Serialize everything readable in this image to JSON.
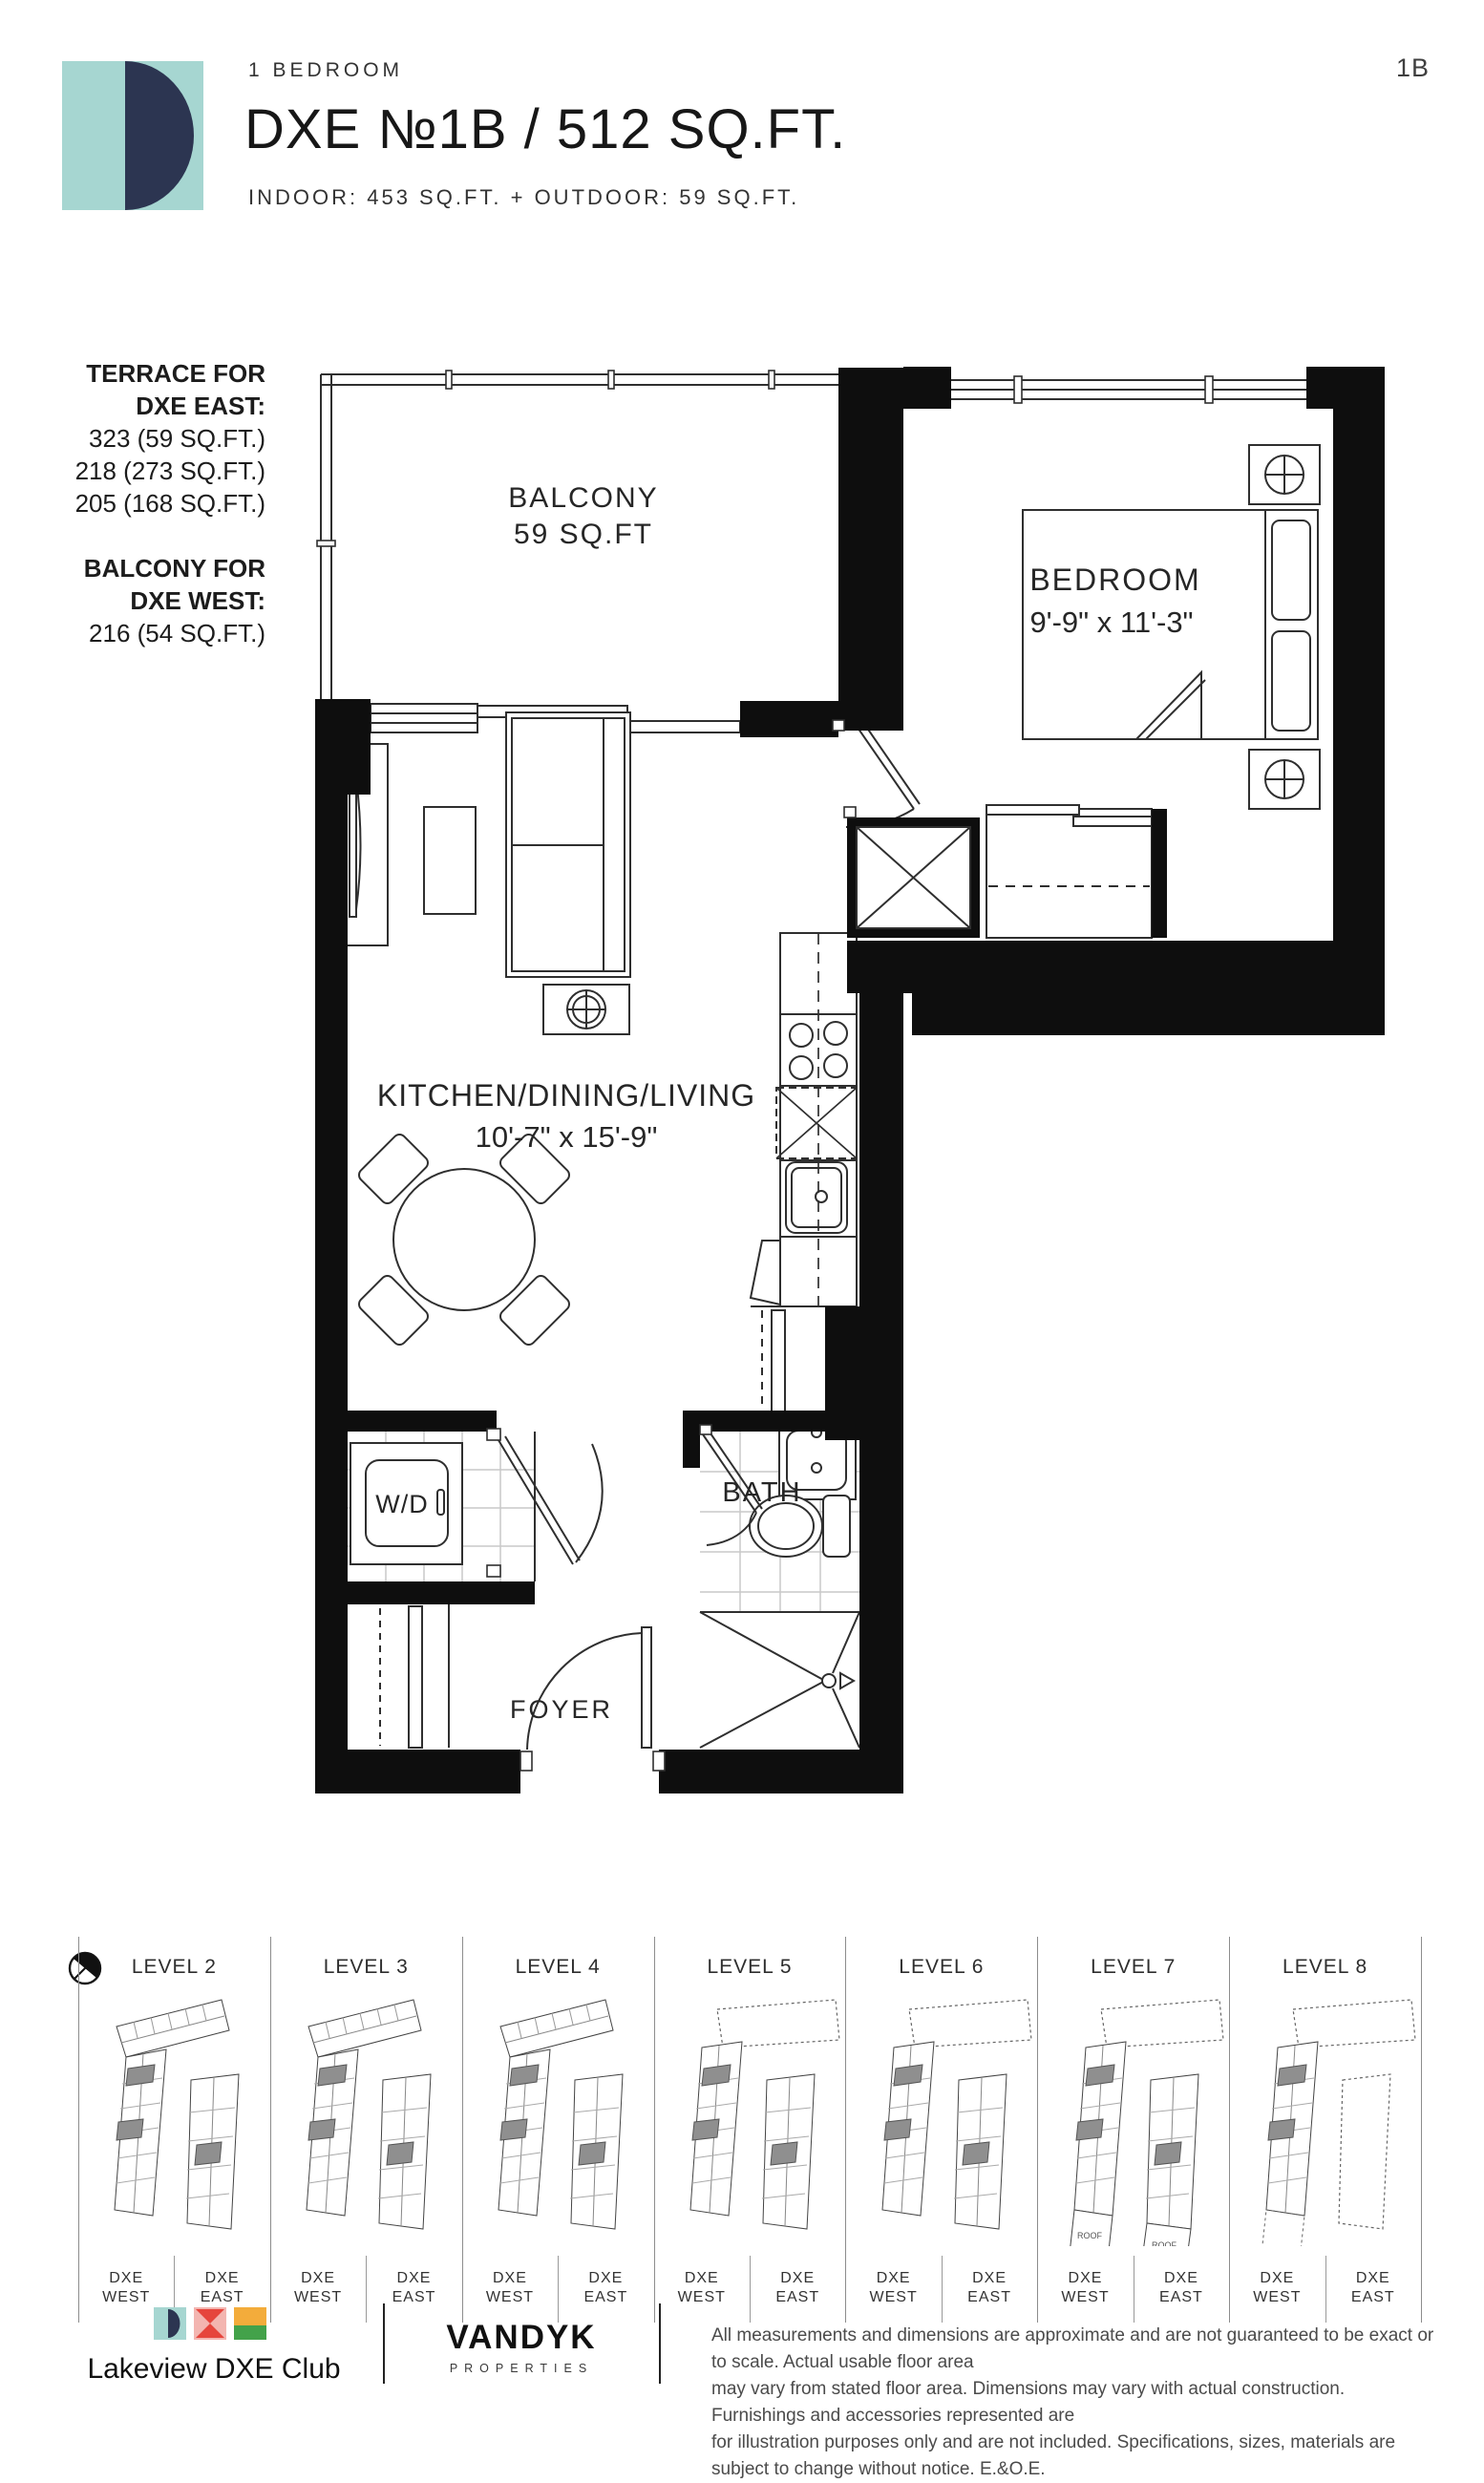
{
  "page": {
    "code": "1B"
  },
  "header": {
    "category": "1 BEDROOM",
    "title": "DXE №1B / 512 SQ.FT.",
    "subtitle": "INDOOR: 453 SQ.FT. + OUTDOOR: 59 SQ.FT."
  },
  "annotations": {
    "terrace_heading_line1": "TERRACE FOR",
    "terrace_heading_line2": "DXE EAST:",
    "terrace_items": [
      "323 (59 SQ.FT.)",
      "218 (273 SQ.FT.)",
      "205 (168 SQ.FT.)"
    ],
    "balcony_heading_line1": "BALCONY FOR",
    "balcony_heading_line2": "DXE WEST:",
    "balcony_items": [
      "216 (54 SQ.FT.)"
    ]
  },
  "plan": {
    "balcony_label": "BALCONY",
    "balcony_area": "59 SQ.FT",
    "bedroom_label": "BEDROOM",
    "bedroom_dims": "9'-9\" x 11'-3\"",
    "living_label": "KITCHEN/DINING/LIVING",
    "living_dims": "10'-7\" x 15'-9\"",
    "wd_label": "W/D",
    "bath_label": "BATH",
    "foyer_label": "FOYER"
  },
  "levels": {
    "west_label_line1": "DXE",
    "west_label_line2": "WEST",
    "east_label_line1": "DXE",
    "east_label_line2": "EAST",
    "roof_label": "ROOF",
    "items": [
      {
        "label": "LEVEL 2",
        "dotted_top": false,
        "east_gray": true,
        "east_dashed": false,
        "roof_west": false,
        "roof_east": false,
        "west_ext_dashed": false
      },
      {
        "label": "LEVEL 3",
        "dotted_top": false,
        "east_gray": true,
        "east_dashed": false,
        "roof_west": false,
        "roof_east": false,
        "west_ext_dashed": false
      },
      {
        "label": "LEVEL 4",
        "dotted_top": false,
        "east_gray": true,
        "east_dashed": false,
        "roof_west": false,
        "roof_east": false,
        "west_ext_dashed": false
      },
      {
        "label": "LEVEL 5",
        "dotted_top": true,
        "east_gray": true,
        "east_dashed": false,
        "roof_west": false,
        "roof_east": false,
        "west_ext_dashed": false
      },
      {
        "label": "LEVEL 6",
        "dotted_top": true,
        "east_gray": true,
        "east_dashed": false,
        "roof_west": false,
        "roof_east": false,
        "west_ext_dashed": false
      },
      {
        "label": "LEVEL 7",
        "dotted_top": true,
        "east_gray": true,
        "east_dashed": false,
        "roof_west": true,
        "roof_east": true,
        "west_ext_dashed": false
      },
      {
        "label": "LEVEL 8",
        "dotted_top": true,
        "east_gray": false,
        "east_dashed": true,
        "roof_west": false,
        "roof_east": false,
        "west_ext_dashed": true
      }
    ]
  },
  "footer": {
    "brand": "Lakeview DXE Club",
    "developer": "VANDYK",
    "developer_sub": "PROPERTIES",
    "disclaimer_lines": [
      "All measurements and dimensions are approximate and are not guaranteed to be exact or to scale. Actual usable floor area",
      "may vary from stated floor area. Dimensions may vary with actual construction. Furnishings and accessories represented are",
      "for illustration purposes only and are not included. Specifications, sizes, materials are subject to change without notice. E.&O.E."
    ]
  },
  "colors": {
    "teal": "#A6D6D1",
    "navy": "#2C3551",
    "pink": "#F3B5B0",
    "red": "#E6453C",
    "amber": "#F3AC3B",
    "green": "#43A24A",
    "wall": "#0E0E0E"
  }
}
